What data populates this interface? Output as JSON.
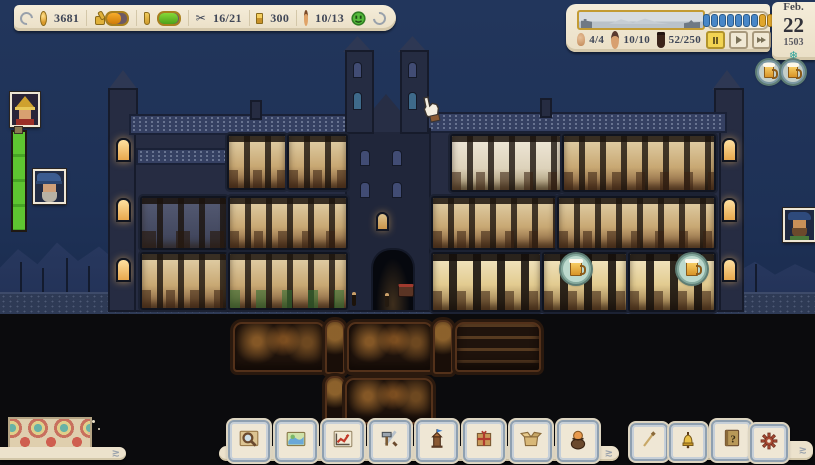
{
  "top_bar": {
    "gold": "3681",
    "food_bar_fill": 66,
    "supplies_bar_fill": 93,
    "tools": "16/21",
    "ingots": "300",
    "monks": "10/13",
    "scissors_glyph": "✂"
  },
  "time_panel": {
    "residents": "4/4",
    "workers": "10/10",
    "storage": "52/250",
    "beads": [
      "blue",
      "blue",
      "blue",
      "blue",
      "blue",
      "blue",
      "blue",
      "yellow",
      "yellow"
    ],
    "speed_controls": [
      "pause",
      "play",
      "fast-forward",
      "fastest"
    ]
  },
  "date": {
    "month": "Feb.",
    "day": "22",
    "year": "1503",
    "season_glyph": "❄"
  },
  "left_hud": {
    "portraits": [
      "helmet-soldier",
      "blue-hat-elder"
    ],
    "meter_fill": 100
  },
  "right_hud": {
    "beer_tokens": 2,
    "portrait": "blue-beret-man"
  },
  "building": {
    "beer_badges": 2,
    "scene": "monastery cross-section, winter night"
  },
  "toolbar": {
    "main_buttons": [
      "inspect",
      "map",
      "statistics",
      "crafting",
      "construction",
      "trade-goods",
      "storage",
      "monks"
    ],
    "side_buttons": [
      "broom",
      "bell"
    ],
    "system_buttons": [
      "help",
      "settings"
    ]
  },
  "colors": {
    "sky": "#1e3156",
    "parchment": "#f0e8d6",
    "accent_gold": "#d9a62e",
    "bar_orange": "#e59310",
    "bar_green": "#63c02e",
    "bead_blue": "#4887c8",
    "bead_yellow": "#e0a62c",
    "badge_teal": "#bcd9cd",
    "settings_red": "#a84a34"
  }
}
